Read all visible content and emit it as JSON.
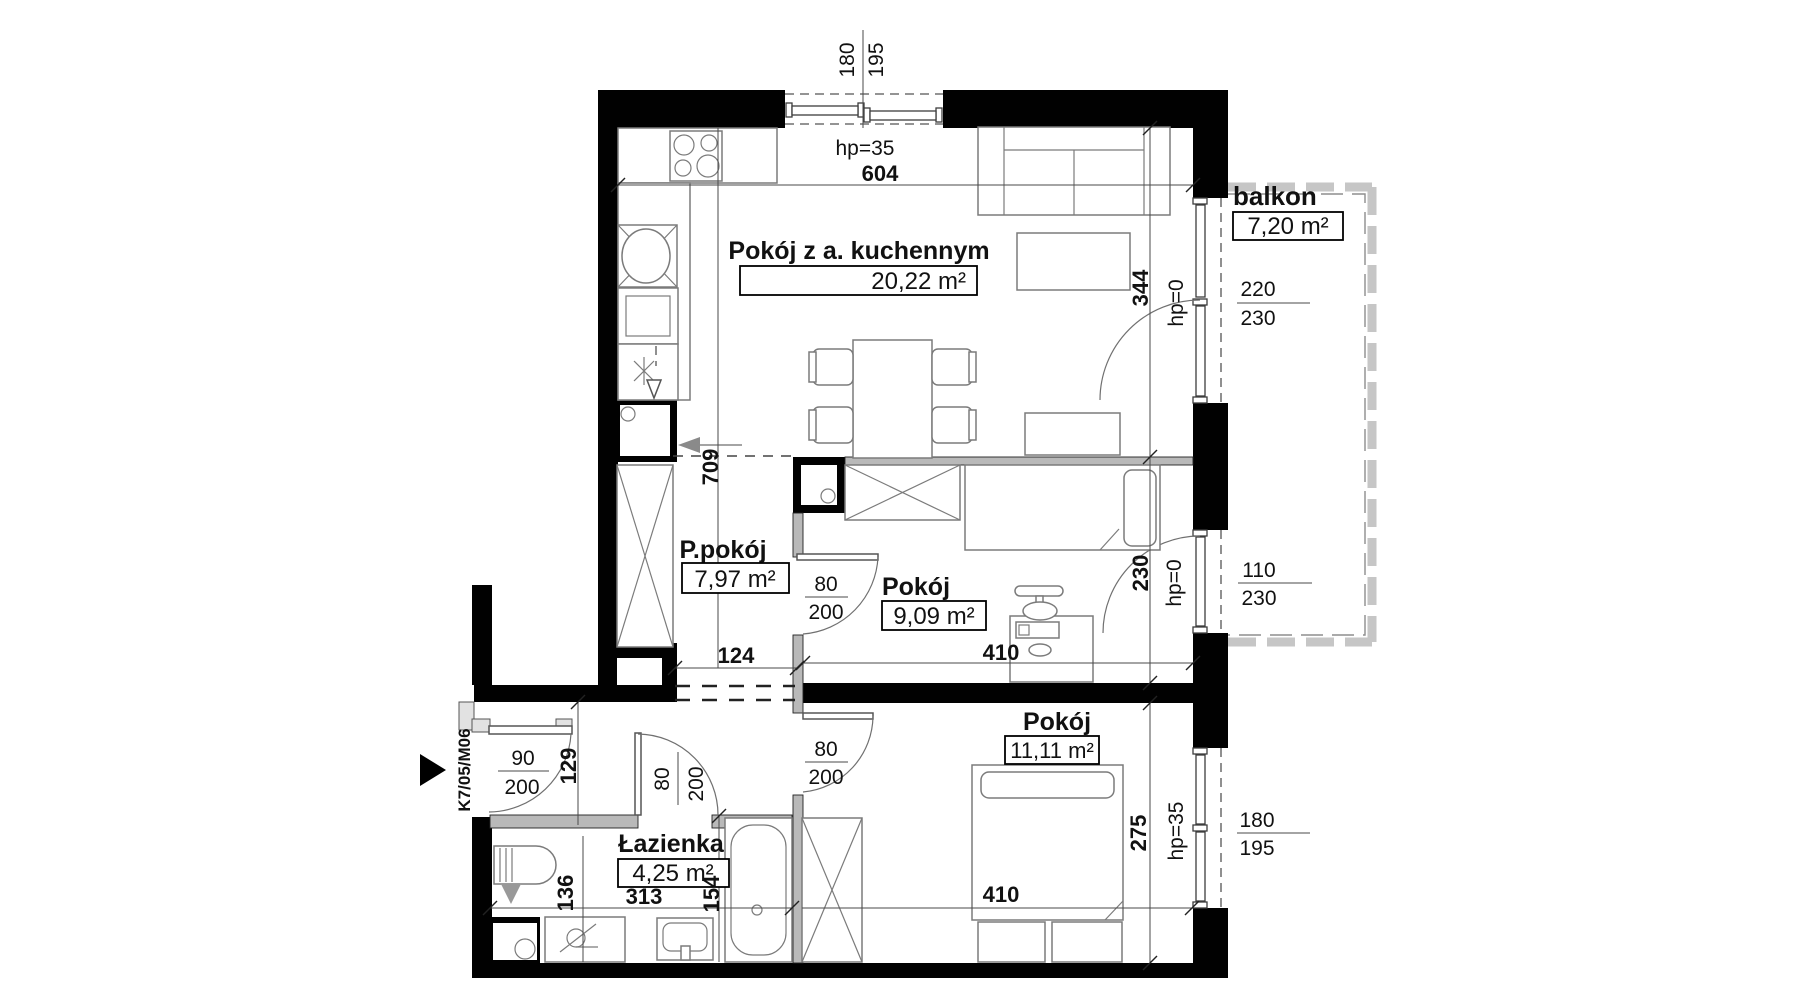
{
  "unit_id": "K7/05/M06",
  "labels": {
    "living": {
      "name": "Pokój z a. kuchennym",
      "area": "20,22 m²"
    },
    "balcony": {
      "name": "balkon",
      "area": "7,20 m²"
    },
    "hall": {
      "name": "P.pokój",
      "area": "7,97 m²"
    },
    "room9": {
      "name": "Pokój",
      "area": "9,09 m²"
    },
    "room11": {
      "name": "Pokój",
      "area": "11,11 m²"
    },
    "bath": {
      "name": "Łazienka",
      "area": "4,25 m²"
    }
  },
  "dims": {
    "living_width": "604",
    "living_window_w": "180",
    "living_window_h": "195",
    "living_window_hp": "hp=35",
    "hall_depth": "709",
    "living_side": "344",
    "balcony_door_hp": "hp=0",
    "balcony_door_w": "220",
    "balcony_door_h": "230",
    "room9_side": "230",
    "room9_door_hp": "hp=0",
    "room9_door_w": "110",
    "room9_door_h": "230",
    "opening_w": "124",
    "room9_width": "410",
    "door80": "80",
    "door200": "200",
    "door90": "90",
    "niche": "129",
    "bath_left": "136",
    "bath_width": "313",
    "bath_right": "154",
    "room11_width": "410",
    "room11_side": "275",
    "room11_window_hp": "hp=35",
    "room11_window_w": "180",
    "room11_window_h": "195"
  },
  "colors": {
    "wall": "#010101",
    "partition": "#b9b9b9",
    "furniture_line": "#7b7b7b",
    "background": "#ffffff"
  }
}
